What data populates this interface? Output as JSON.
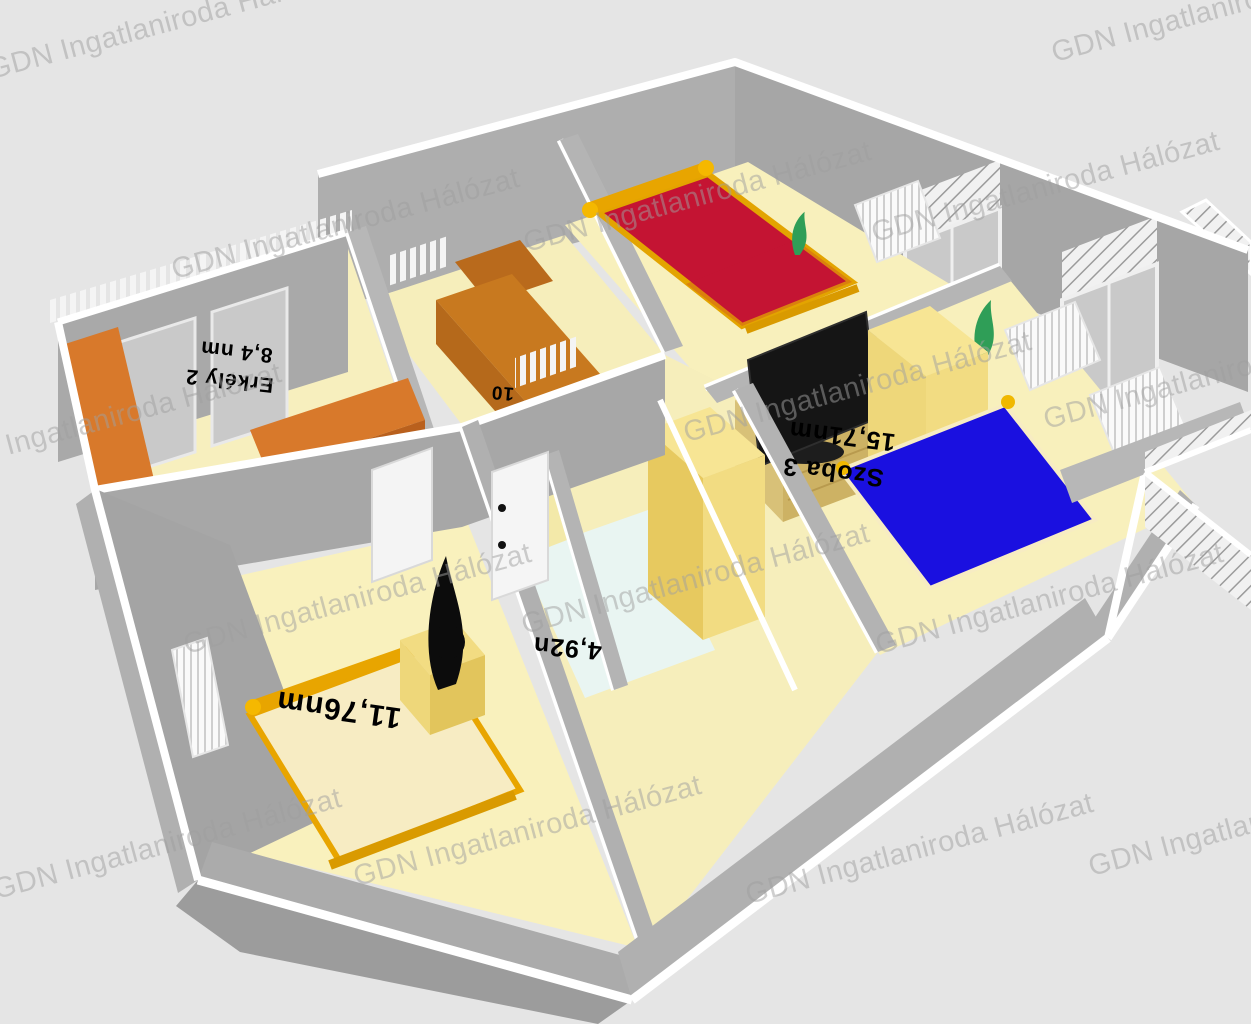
{
  "watermark": {
    "text": "GDN Ingatlaniroda Hálózat"
  },
  "floorplan": {
    "description": "3D apartment floor plan render",
    "rooms": [
      {
        "key": "erkely-2",
        "name": "Erkély 2",
        "area": "8,4 nm"
      },
      {
        "key": "szoba-1",
        "name": "",
        "area": "11,76nm"
      },
      {
        "key": "furdoszoba",
        "name": "",
        "area": "4,92n"
      },
      {
        "key": "szoba-3",
        "name": "Szoba 3",
        "area": "15,71nm"
      },
      {
        "key": "kozlekedo",
        "name": "",
        "area": "10"
      }
    ],
    "colors": {
      "background": "#e5e5e5",
      "wall": "#aeaeae",
      "wall_dark": "#9c9c9c",
      "wall_top": "#ffffff",
      "floor": "#f8f0bc",
      "bathroom_floor": "#e9f5f2",
      "accent_orange": "#d8792b",
      "stair_orange": "#c8791f",
      "bed_red": "#c41433",
      "bed_blue": "#1a10e0",
      "wood_gold": "#e8a500",
      "wardrobe_yellow": "#f2dc82",
      "cabinet_tan": "#cdb264",
      "plant_green": "#2f9e57",
      "tv_black": "#151515",
      "bedding_cream": "#f7ecc3",
      "label_color": "#000000"
    }
  }
}
